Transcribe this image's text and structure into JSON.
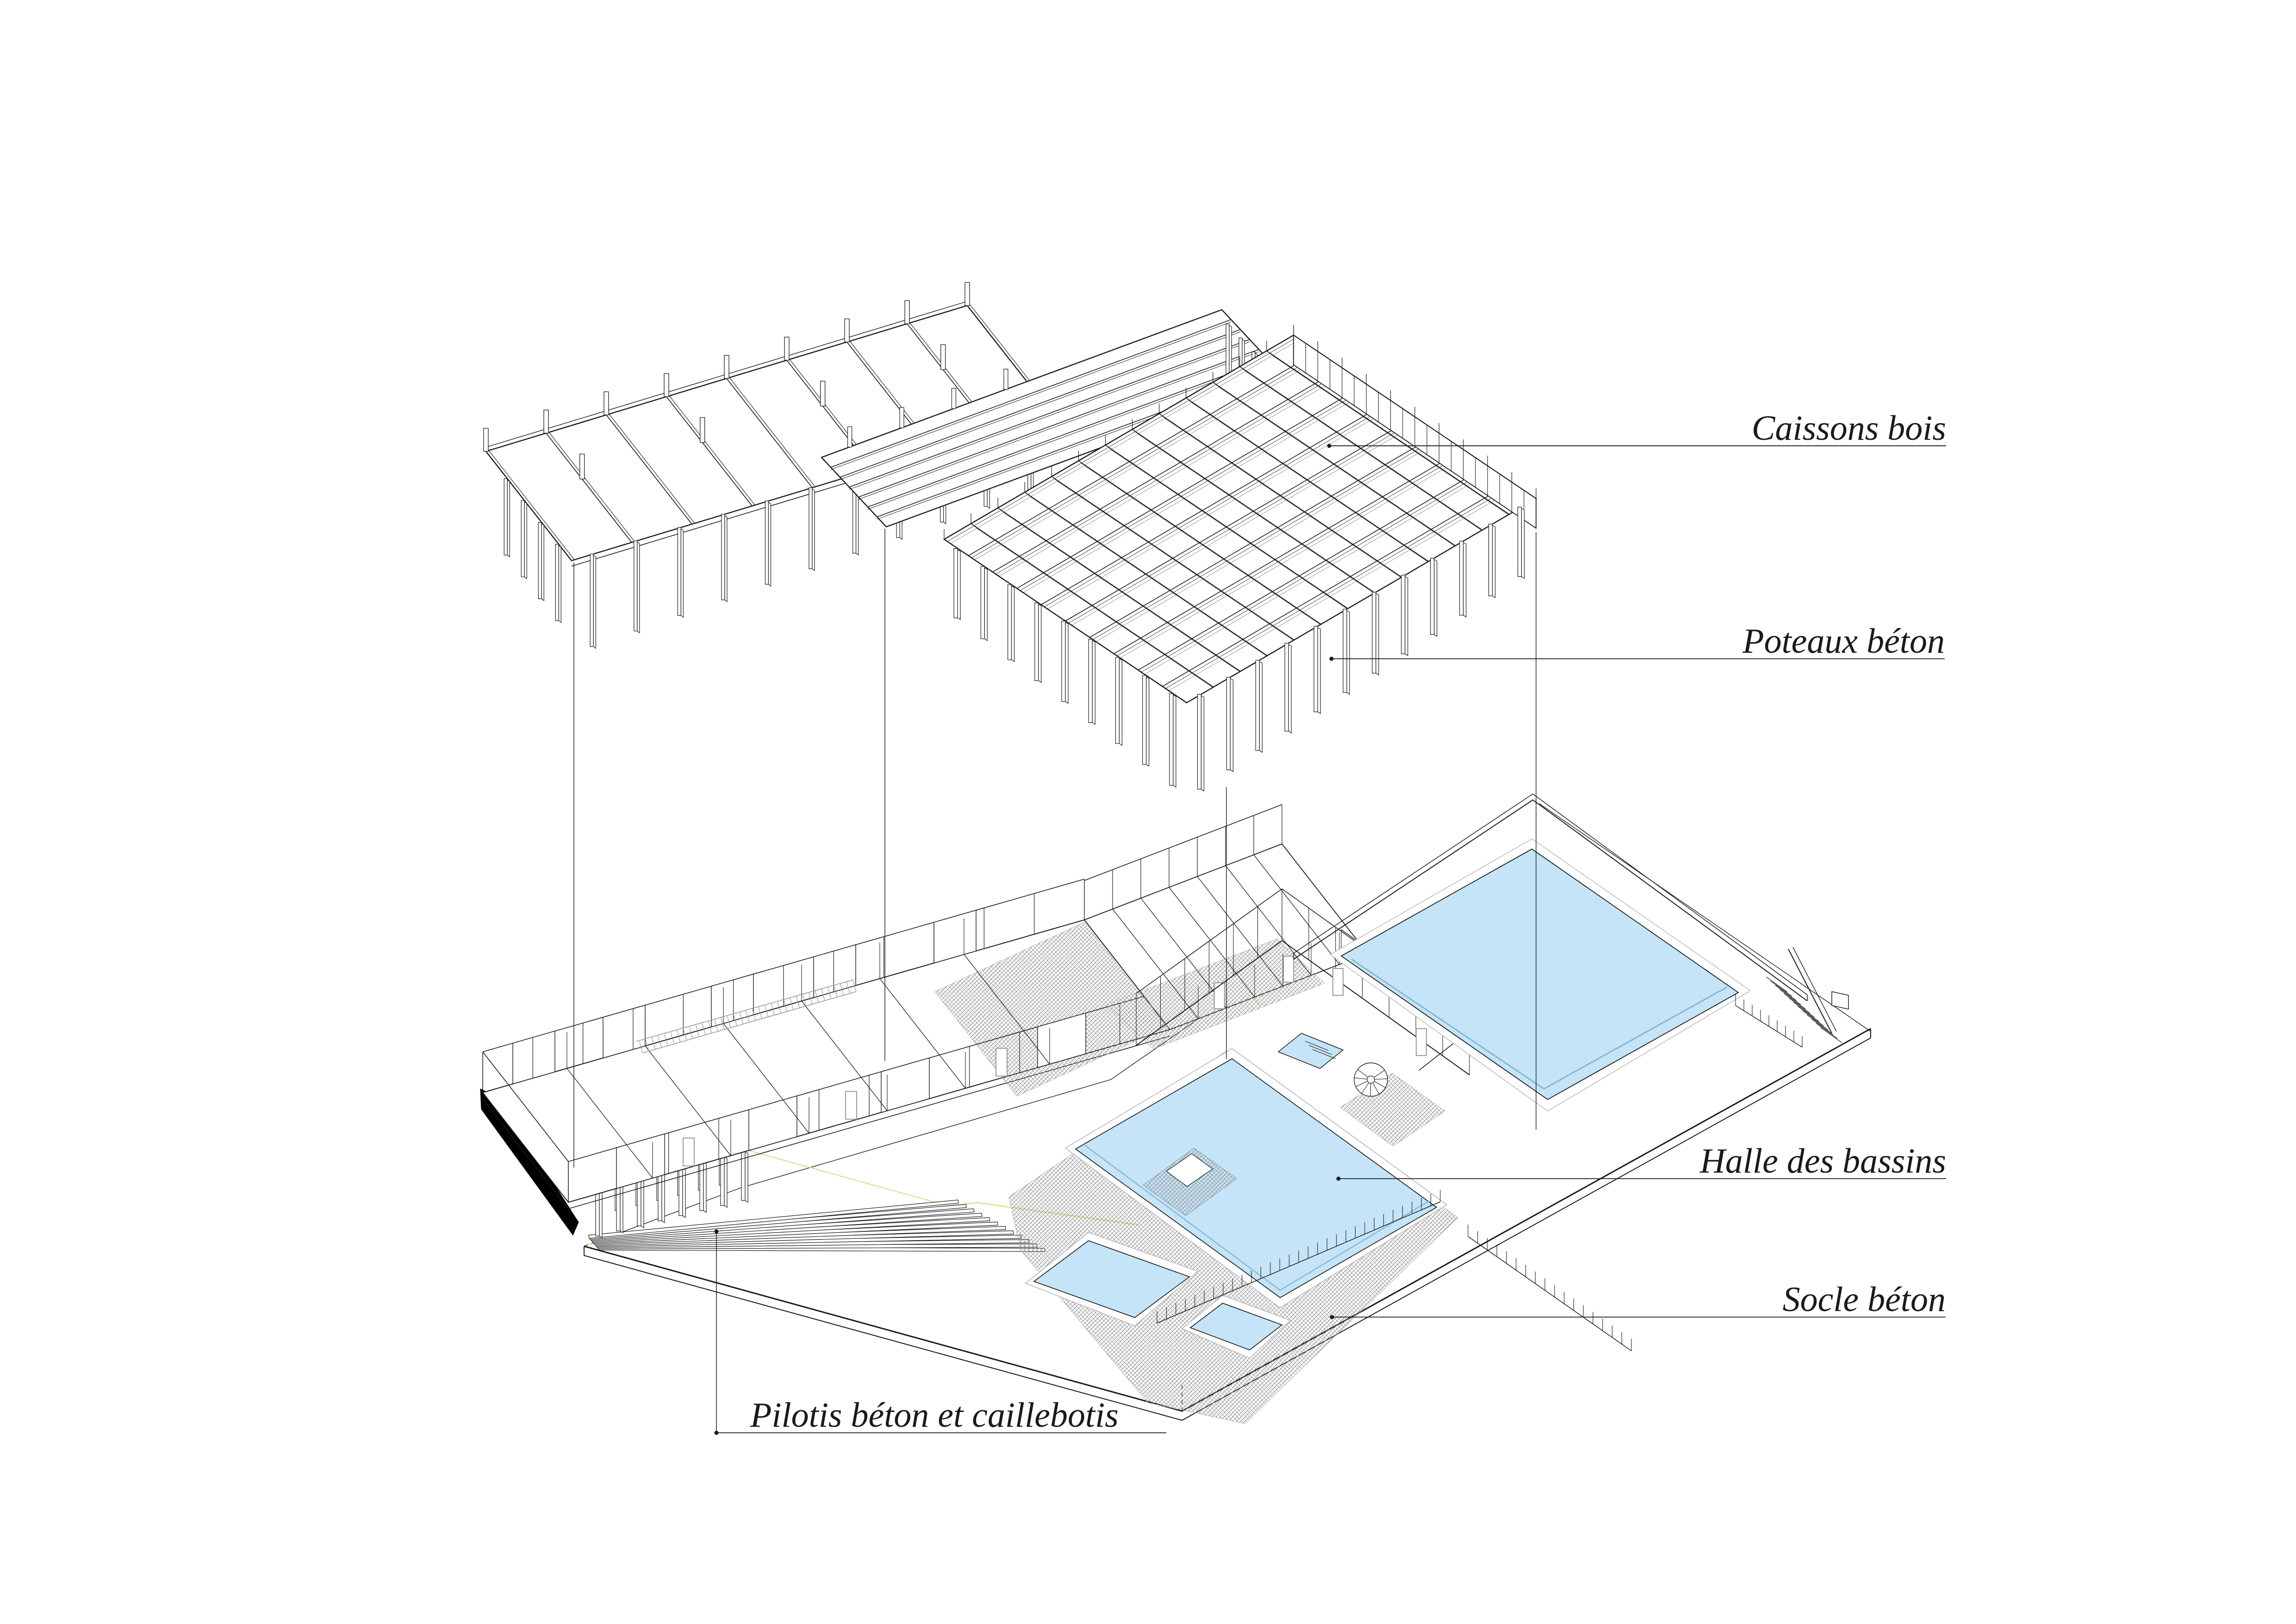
{
  "drawing": {
    "type": "exploded-axonometric-architecture",
    "subject": "piscine (swimming pool complex) — exploded structural axonometric",
    "annotations": {
      "caissons": "Caissons bois",
      "poteaux": "Poteaux béton",
      "halle": "Halle des bassins",
      "socle": "Socle béton",
      "pilotis": "Pilotis béton et caillebotis"
    },
    "palette": {
      "line": "#1a1a1a",
      "pool_fill": "#c5e4f7",
      "pool_inner_line": "#84b8d5",
      "pool_coping": "#b9bdc2",
      "hatch_gray": "#8a8a8a",
      "accent_yellow": "#e6d98c",
      "solid_black": "#000000",
      "gray_detail": "#999999",
      "background": "#ffffff"
    }
  }
}
